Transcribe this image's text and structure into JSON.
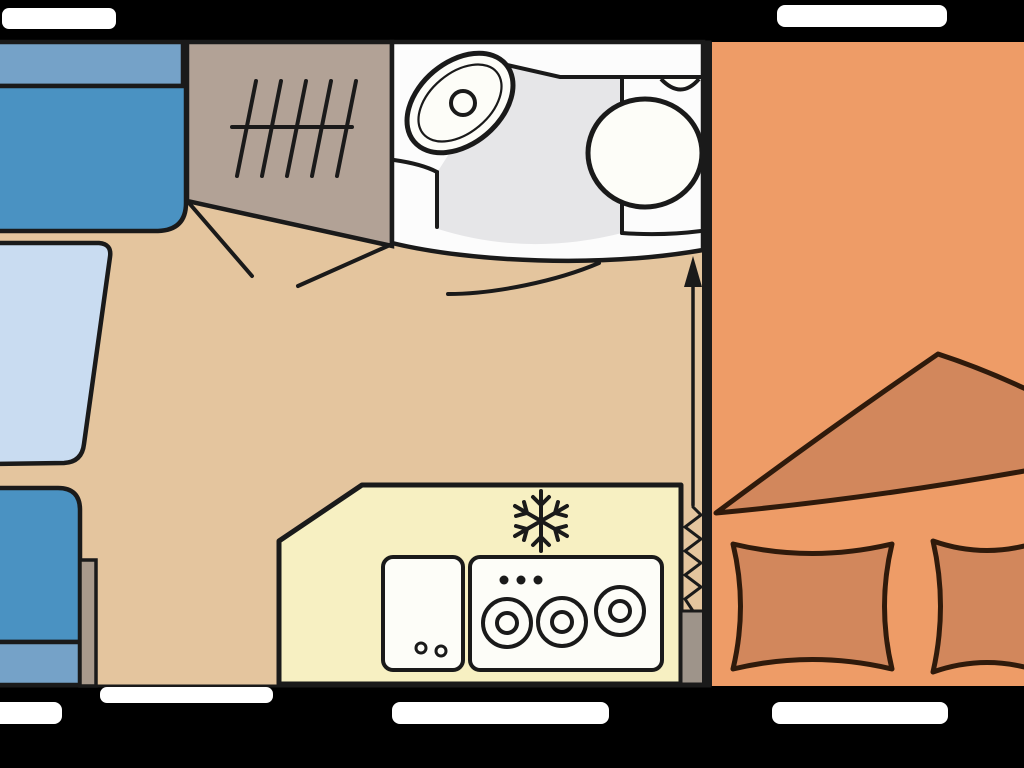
{
  "diagram": {
    "type": "caravan-floorplan-top-view",
    "rooms": [
      "lounge-dinette",
      "wardrobe",
      "bathroom",
      "kitchen",
      "bedroom"
    ],
    "features": [
      "front-bench-seat",
      "rear-bench-seat",
      "dinette-table",
      "wardrobe-with-hanging-rail",
      "washbasin",
      "toilet",
      "kitchen-sink",
      "three-burner-hob",
      "freezer-compartment",
      "double-bed",
      "blanket",
      "two-pillows",
      "entry-door",
      "five-windows",
      "bed-extension-arrow"
    ]
  },
  "icons": {
    "wardrobe_rail": "hatch-tally-marks-icon",
    "freezer": "snowflake-icon",
    "hob": "three-burner-rings-icon",
    "bed_mechanism": "zigzag-spring-and-arrow-icon",
    "door_swing": "arc-line-icon"
  },
  "colors": {
    "background": "#000000",
    "window": "#ffffff",
    "floor": "#e4c59e",
    "seat_cushion": "#4a92c2",
    "seat_backrest": "#75a2c8",
    "table": "#c9dcf1",
    "wardrobe": "#b2a296",
    "side_panel": "#a99a8c",
    "bathroom_wall": "#fcfcfc",
    "bathroom_floor": "#e6e6e8",
    "kitchen": "#f7f0c2",
    "appliance": "#fdfdf8",
    "bedroom": "#ee9c67",
    "bedding": "#d2875c",
    "bedding_outline": "#2f1a0b",
    "metal": "#9e948a",
    "outline": "#1a1a1a"
  }
}
